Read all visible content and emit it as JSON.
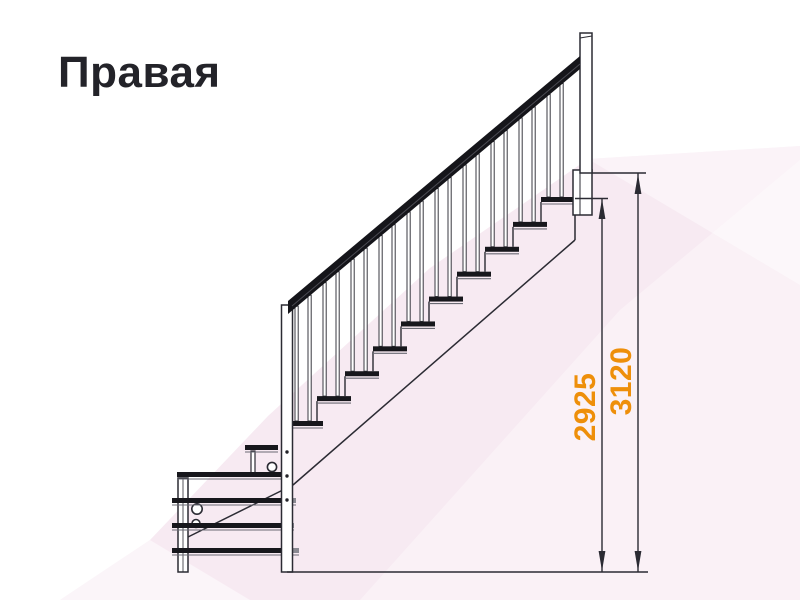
{
  "title": "Правая",
  "colors": {
    "accent_orange": "#ee8f0a",
    "line": "#2b2b33",
    "tread_black": "#17171c",
    "background_pink": "#f7eaf2"
  },
  "diagram": {
    "type": "staircase-side-view-technical-drawing",
    "description_labels": [],
    "dimensions": [
      {
        "label": "2925",
        "orientation": "vertical",
        "color": "#ee8f0a"
      },
      {
        "label": "3120",
        "orientation": "vertical",
        "color": "#ee8f0a"
      }
    ]
  }
}
